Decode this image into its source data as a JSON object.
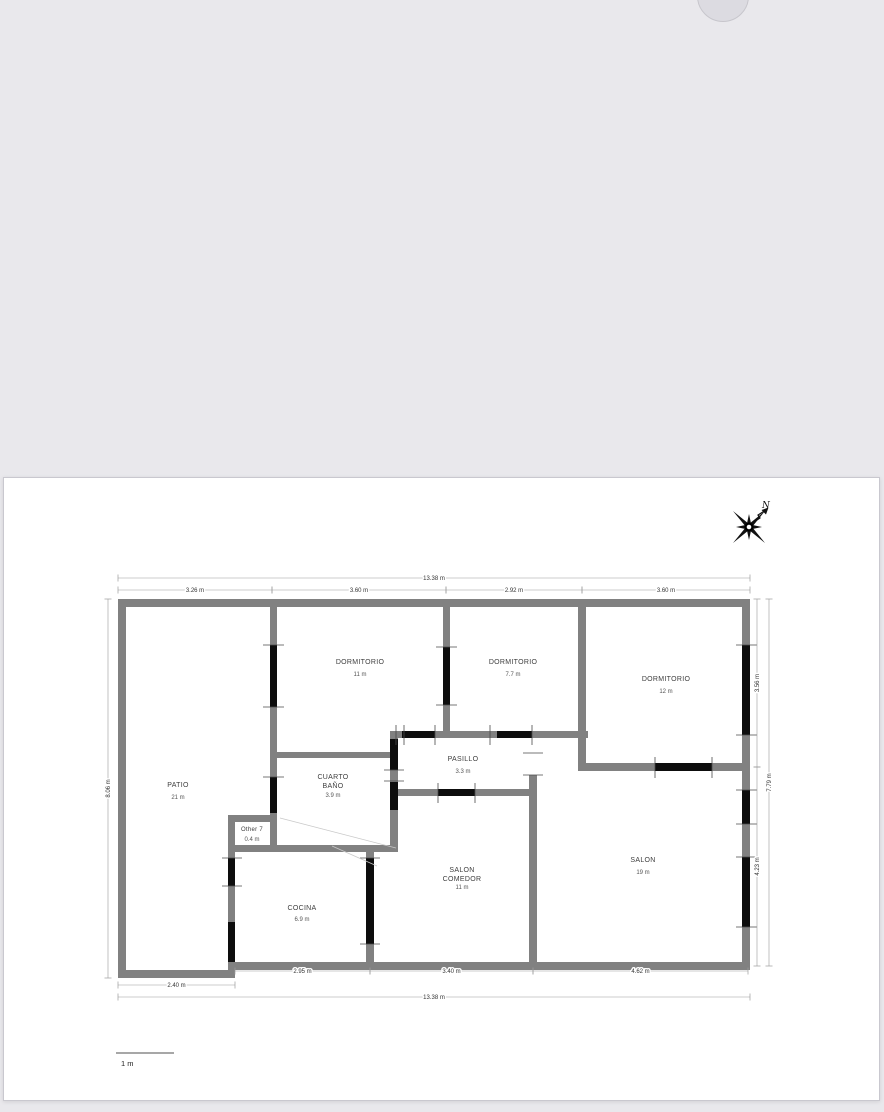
{
  "page": {
    "canvas_bg": "#e9e8ec",
    "sheet_bg": "#ffffff"
  },
  "compass": {
    "north_label": "N"
  },
  "scale_bar": {
    "label": "1 m"
  },
  "floorplan": {
    "colors": {
      "wall": "#818181",
      "opening": "#0d0d0d",
      "tick": "#4a4a4a",
      "diagonal": "#c9c9c9",
      "dim_line": "#9a9a9a",
      "dim_text": "#333333",
      "room_text": "#3d3d3d",
      "area_text": "#555555"
    },
    "rooms": [
      {
        "lines": [
          "DORMITORIO"
        ],
        "area": "11 m",
        "x": 360,
        "y": 664,
        "ay": 676
      },
      {
        "lines": [
          "DORMITORIO"
        ],
        "area": "7.7 m",
        "x": 513,
        "y": 664,
        "ay": 676
      },
      {
        "lines": [
          "DORMITORIO"
        ],
        "area": "12 m",
        "x": 666,
        "y": 681,
        "ay": 693
      },
      {
        "lines": [
          "PATIO"
        ],
        "area": "21 m",
        "x": 178,
        "y": 787,
        "ay": 799
      },
      {
        "lines": [
          "CUARTO",
          "BAÑO"
        ],
        "area": "3.9 m",
        "x": 333,
        "y": 779,
        "ay": 797
      },
      {
        "lines": [
          "PASILLO"
        ],
        "area": "3.3 m",
        "x": 463,
        "y": 761,
        "ay": 773
      },
      {
        "lines": [
          "Other 7"
        ],
        "area": "0.4 m",
        "x": 252,
        "y": 831,
        "ay": 841,
        "fs": 6
      },
      {
        "lines": [
          "COCINA"
        ],
        "area": "6.9 m",
        "x": 302,
        "y": 910,
        "ay": 921
      },
      {
        "lines": [
          "SALON",
          "COMEDOR"
        ],
        "area": "11 m",
        "x": 462,
        "y": 872,
        "ay": 889
      },
      {
        "lines": [
          "SALON"
        ],
        "area": "19 m",
        "x": 643,
        "y": 862,
        "ay": 874
      }
    ],
    "walls": [
      [
        118,
        599,
        632,
        8
      ],
      [
        118,
        599,
        8,
        379
      ],
      [
        742,
        599,
        8,
        367
      ],
      [
        228,
        962,
        522,
        8
      ],
      [
        118,
        970,
        117,
        8
      ],
      [
        270,
        599,
        7,
        216
      ],
      [
        443,
        599,
        7,
        139
      ],
      [
        578,
        599,
        8,
        172
      ],
      [
        578,
        763,
        172,
        8
      ],
      [
        390,
        731,
        198,
        7
      ],
      [
        390,
        731,
        8,
        121
      ],
      [
        270,
        752,
        128,
        6
      ],
      [
        390,
        789,
        147,
        7
      ],
      [
        529,
        775,
        8,
        191
      ],
      [
        228,
        845,
        170,
        7
      ],
      [
        228,
        815,
        49,
        7
      ],
      [
        228,
        815,
        7,
        37
      ],
      [
        270,
        813,
        7,
        32
      ],
      [
        228,
        852,
        7,
        110
      ],
      [
        366,
        845,
        8,
        117
      ]
    ],
    "openings": [
      [
        270,
        645,
        7,
        62
      ],
      [
        270,
        777,
        7,
        36
      ],
      [
        443,
        647,
        7,
        58
      ],
      [
        742,
        645,
        8,
        90
      ],
      [
        742,
        790,
        8,
        34
      ],
      [
        742,
        857,
        8,
        70
      ],
      [
        655,
        763,
        57,
        8
      ],
      [
        402,
        731,
        33,
        7
      ],
      [
        497,
        731,
        35,
        7
      ],
      [
        390,
        739,
        8,
        31
      ],
      [
        390,
        782,
        8,
        28
      ],
      [
        438,
        789,
        37,
        7
      ],
      [
        366,
        858,
        8,
        86
      ],
      [
        228,
        858,
        7,
        28
      ],
      [
        228,
        922,
        7,
        40
      ]
    ],
    "ticks": [
      [
        263,
        645,
        284,
        645
      ],
      [
        263,
        707,
        284,
        707
      ],
      [
        436,
        647,
        457,
        647
      ],
      [
        436,
        705,
        457,
        705
      ],
      [
        736,
        645,
        757,
        645
      ],
      [
        736,
        735,
        757,
        735
      ],
      [
        736,
        790,
        757,
        790
      ],
      [
        736,
        824,
        757,
        824
      ],
      [
        736,
        857,
        757,
        857
      ],
      [
        736,
        927,
        757,
        927
      ],
      [
        655,
        757,
        655,
        778
      ],
      [
        712,
        757,
        712,
        778
      ],
      [
        396,
        725,
        396,
        745
      ],
      [
        404,
        725,
        404,
        745
      ],
      [
        435,
        725,
        435,
        745
      ],
      [
        490,
        725,
        490,
        745
      ],
      [
        532,
        725,
        532,
        745
      ],
      [
        384,
        770,
        404,
        770
      ],
      [
        384,
        781,
        404,
        781
      ],
      [
        438,
        783,
        438,
        803
      ],
      [
        475,
        783,
        475,
        803
      ],
      [
        523,
        753,
        543,
        753
      ],
      [
        523,
        775,
        543,
        775
      ],
      [
        360,
        858,
        380,
        858
      ],
      [
        360,
        944,
        380,
        944
      ],
      [
        222,
        858,
        242,
        858
      ],
      [
        222,
        886,
        242,
        886
      ],
      [
        263,
        777,
        284,
        777
      ]
    ],
    "diagonals": [
      [
        280,
        818,
        396,
        848
      ],
      [
        332,
        846,
        377,
        866
      ]
    ],
    "dimensions": [
      {
        "label": "13.38 m",
        "line": [
          118,
          578,
          750,
          578
        ]
      },
      {
        "label": "3.26 m",
        "line": [
          118,
          590,
          272,
          590
        ]
      },
      {
        "label": "3.60 m",
        "line": [
          272,
          590,
          446,
          590
        ]
      },
      {
        "label": "2.92 m",
        "line": [
          446,
          590,
          582,
          590
        ]
      },
      {
        "label": "3.60 m",
        "line": [
          582,
          590,
          750,
          590
        ]
      },
      {
        "label": "2.95 m",
        "line": [
          235,
          971,
          370,
          971
        ]
      },
      {
        "label": "3.40 m",
        "line": [
          370,
          971,
          533,
          971
        ]
      },
      {
        "label": "4.62 m",
        "line": [
          533,
          971,
          748,
          971
        ]
      },
      {
        "label": "2.40 m",
        "line": [
          118,
          985,
          235,
          985
        ]
      },
      {
        "label": "13.38 m",
        "line": [
          118,
          997,
          750,
          997
        ]
      },
      {
        "label": "8.06 m",
        "line": [
          108,
          599,
          108,
          978
        ]
      },
      {
        "label": "3.56 m",
        "line": [
          757,
          599,
          757,
          767
        ]
      },
      {
        "label": "4.23 m",
        "line": [
          757,
          767,
          757,
          966
        ]
      },
      {
        "label": "7.79 m",
        "line": [
          769,
          599,
          769,
          966
        ]
      }
    ]
  }
}
